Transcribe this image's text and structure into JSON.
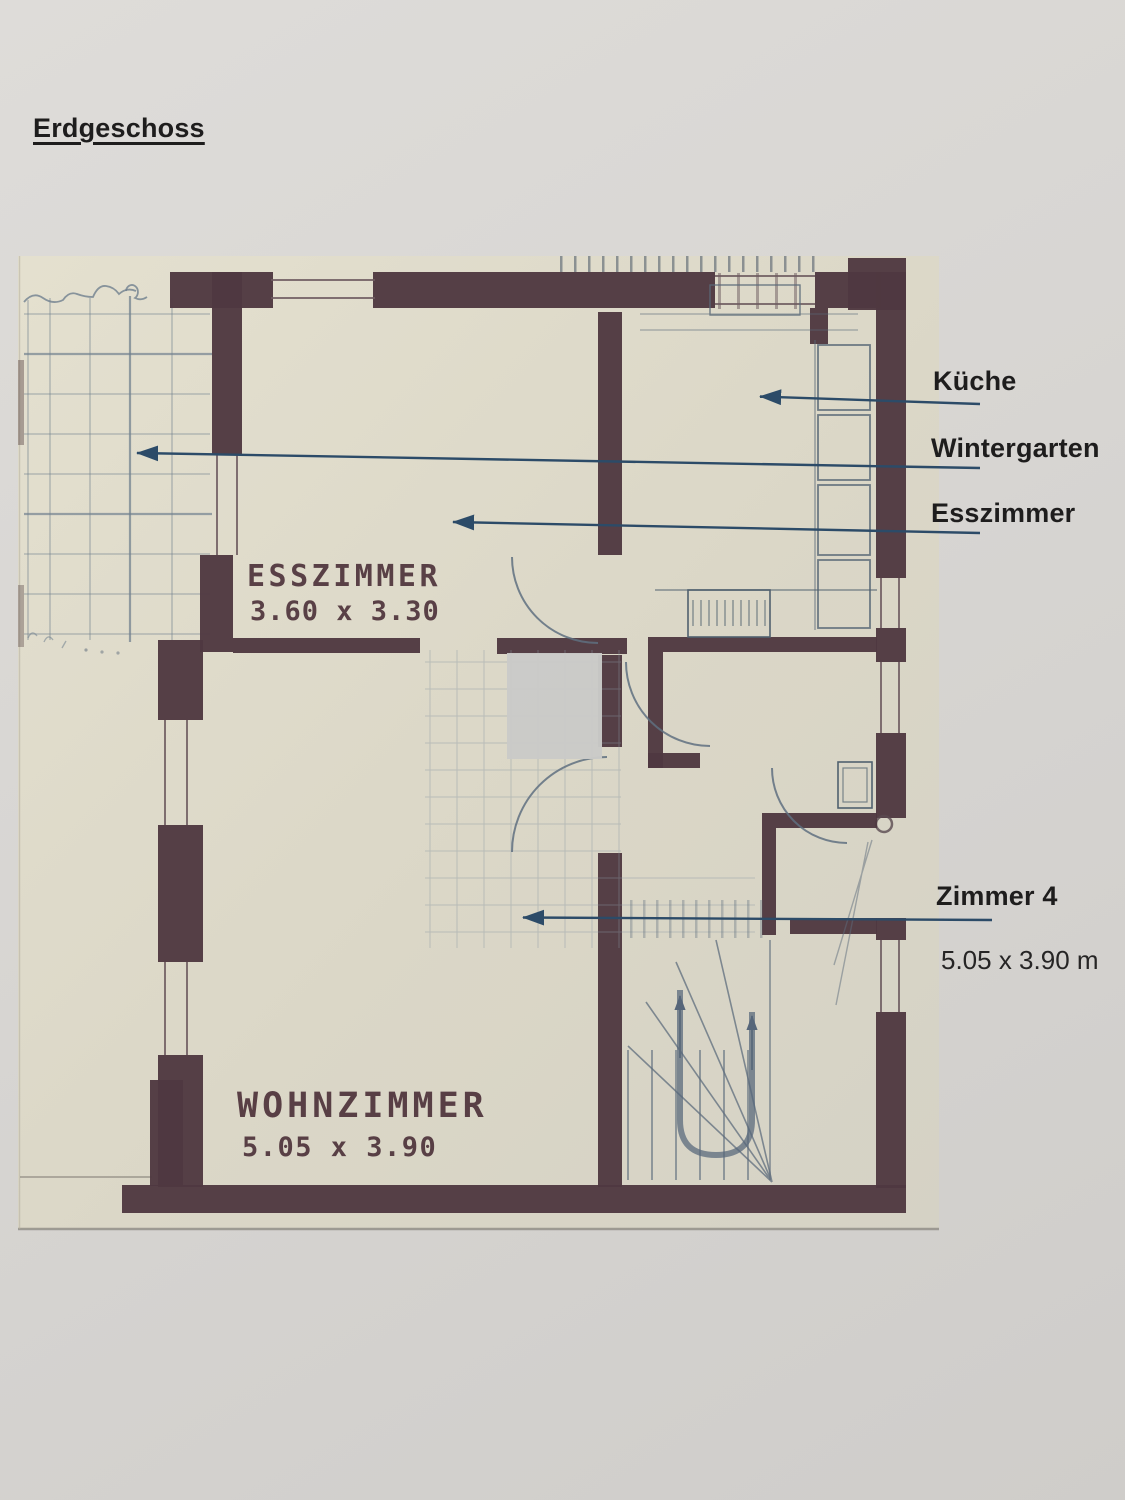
{
  "page": {
    "title": "Erdgeschoss"
  },
  "callouts": {
    "kueche": {
      "label": "Küche"
    },
    "wintergarten": {
      "label": "Wintergarten"
    },
    "esszimmer": {
      "label": "Esszimmer"
    },
    "zimmer4": {
      "label": "Zimmer 4",
      "dimensions": "5.05 x 3.90 m"
    }
  },
  "plan": {
    "rooms": [
      {
        "name": "ESSZIMMER",
        "size": "3.60 x 3.30"
      },
      {
        "name": "WOHNZIMMER",
        "size": "5.05 x 3.90"
      }
    ]
  },
  "colors": {
    "wall": "#4f3841",
    "blueprint": "#6f7f8e",
    "arrow": "#2c4b68",
    "ink": "#1e1d1d",
    "plan_text": "#4e333b",
    "scan_paper": "#ddd9c8",
    "page_background": "#d7d5d2"
  }
}
